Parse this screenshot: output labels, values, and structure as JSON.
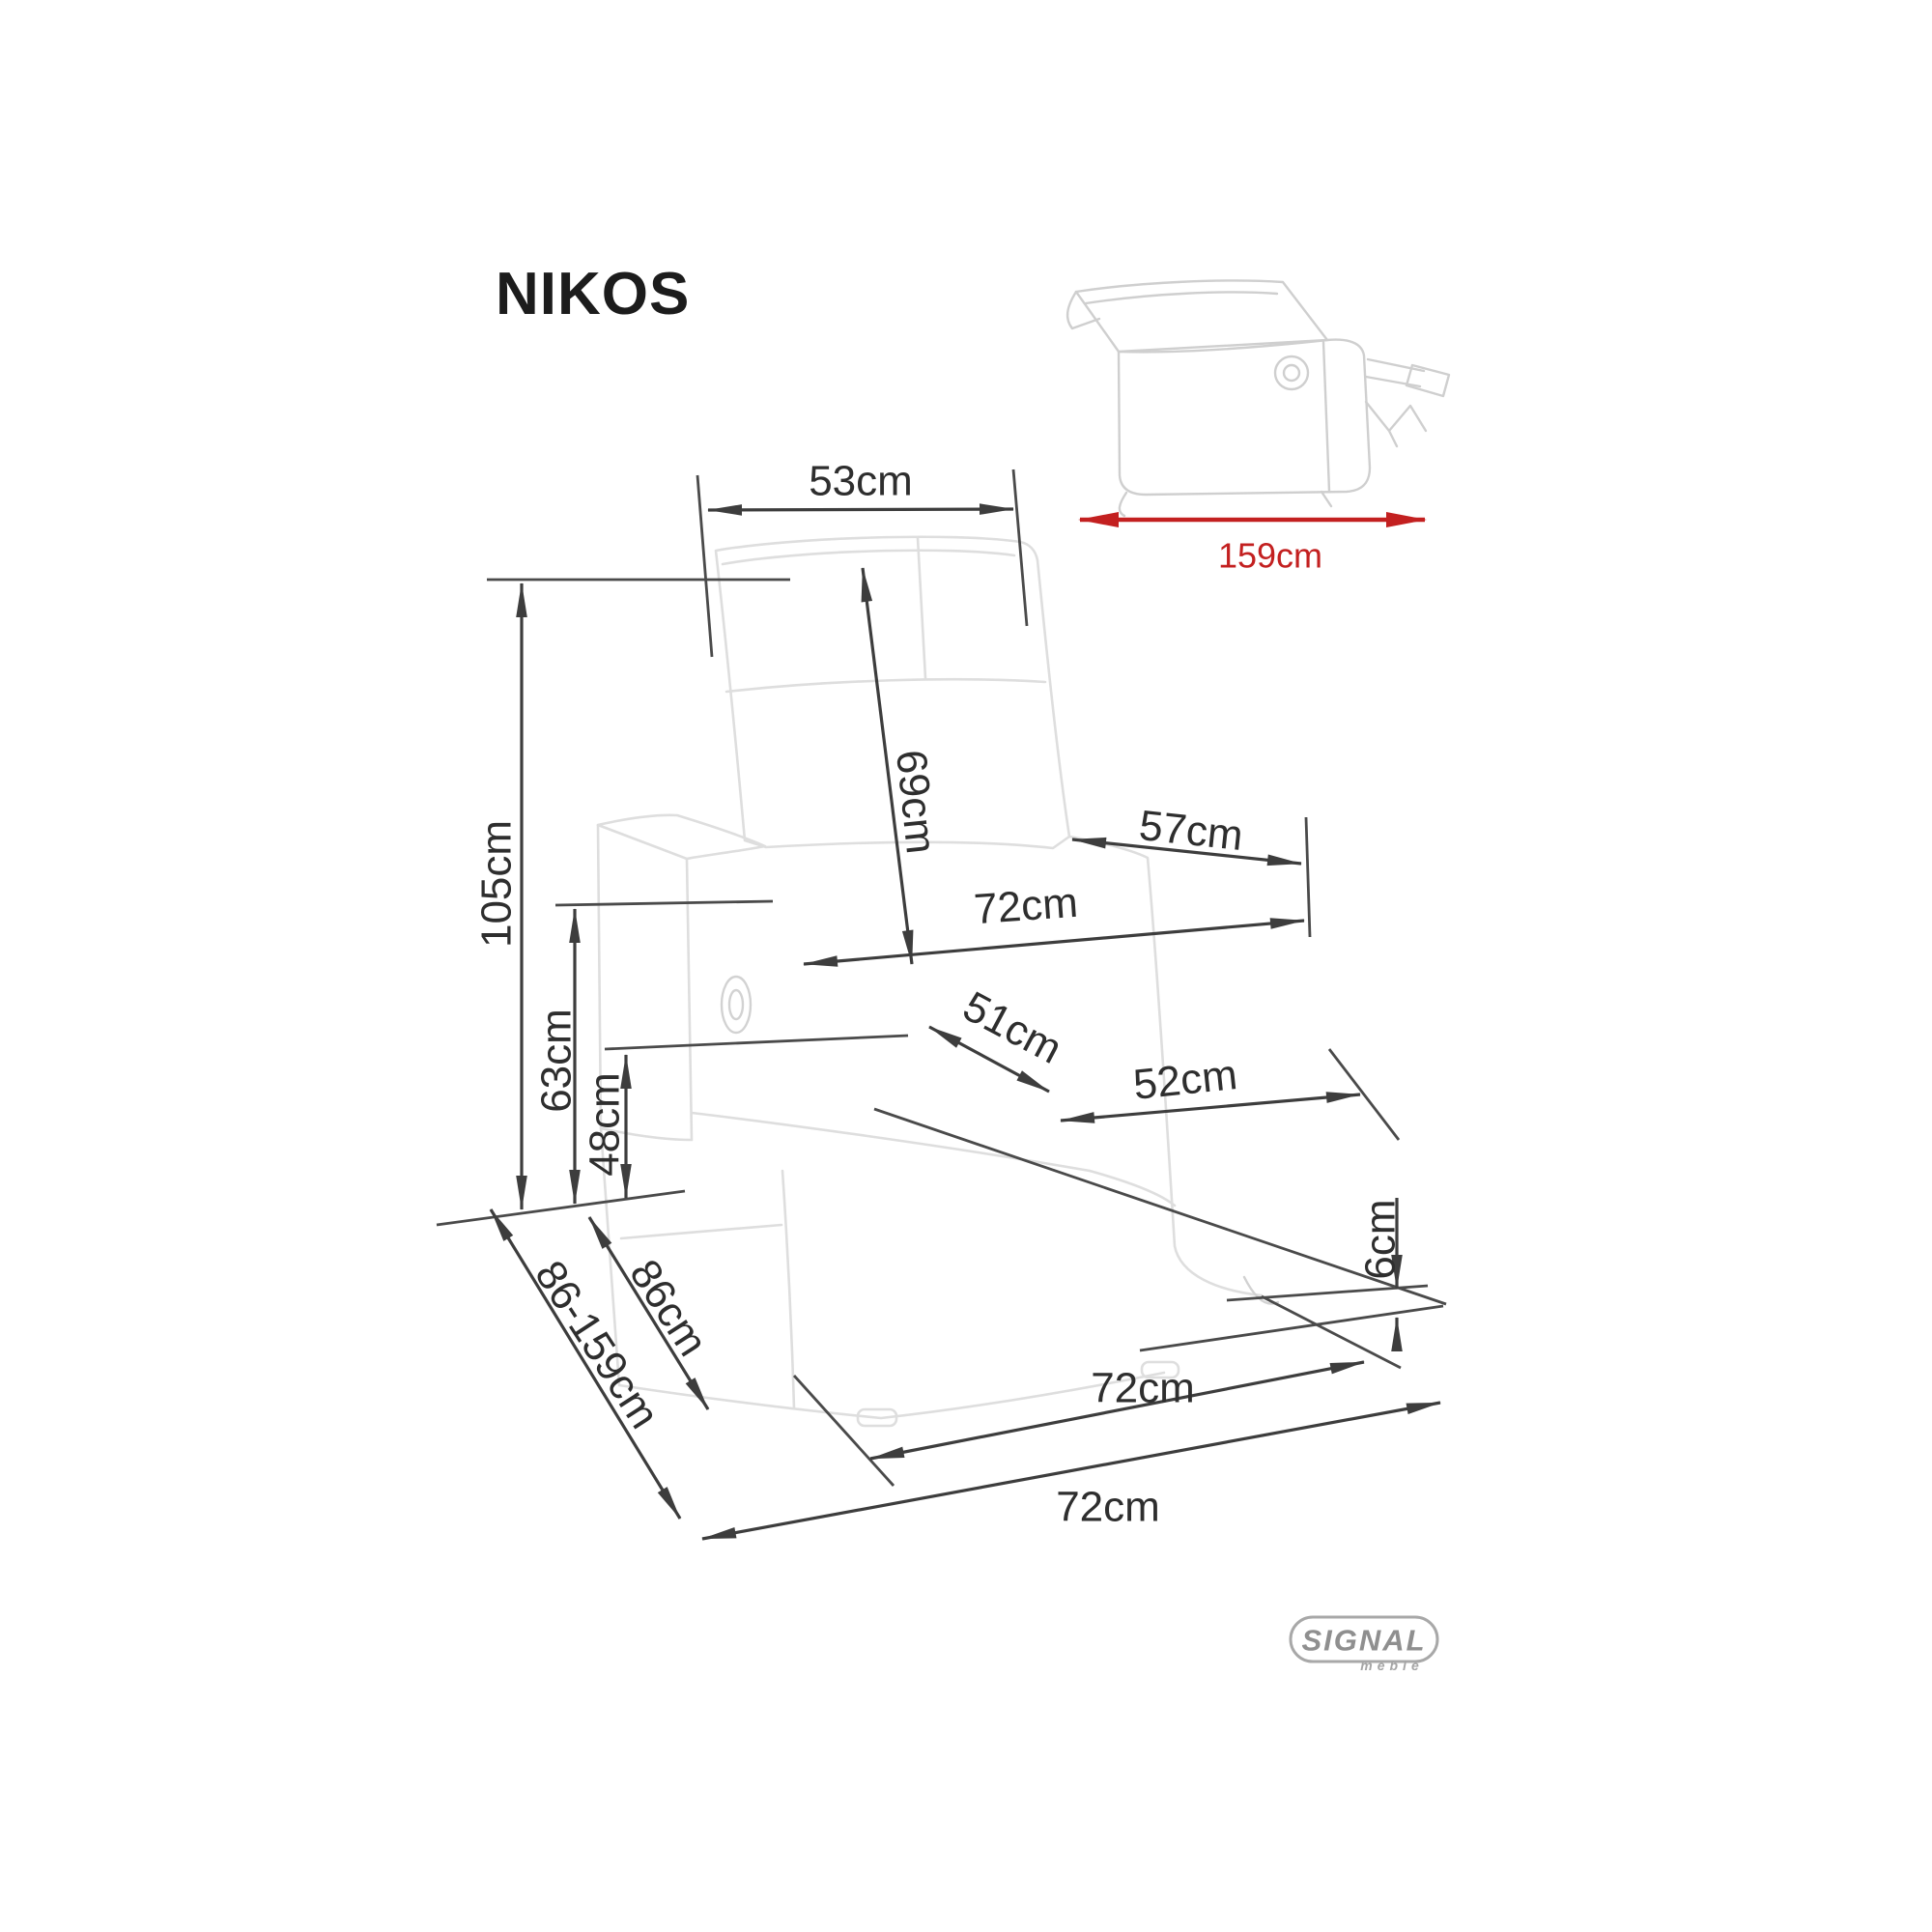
{
  "title": "NIKOS",
  "side_view": {
    "dimension_label": "159cm"
  },
  "dimensions": {
    "backrest_width": "53cm",
    "backrest_length": "69cm",
    "total_height": "105cm",
    "seat_back_to_arm_front": "57cm",
    "width_between_outer_arms": "72cm",
    "seat_depth": "51cm",
    "seat_width": "52cm",
    "armrest_height": "63cm",
    "seat_height": "48cm",
    "ground_clearance": "6cm",
    "base_width": "72cm",
    "overall_width": "72cm",
    "depth_upright": "86cm",
    "depth_range_reclined": "86-159cm"
  },
  "brand": {
    "name": "SIGNAL",
    "tagline": "meble"
  },
  "colors": {
    "dimension_lines": "#3d3d3d",
    "accent_red": "#c32020",
    "sketch_gray": "#dedede",
    "logo_gray": "#8f8f8f",
    "background": "#ffffff"
  }
}
